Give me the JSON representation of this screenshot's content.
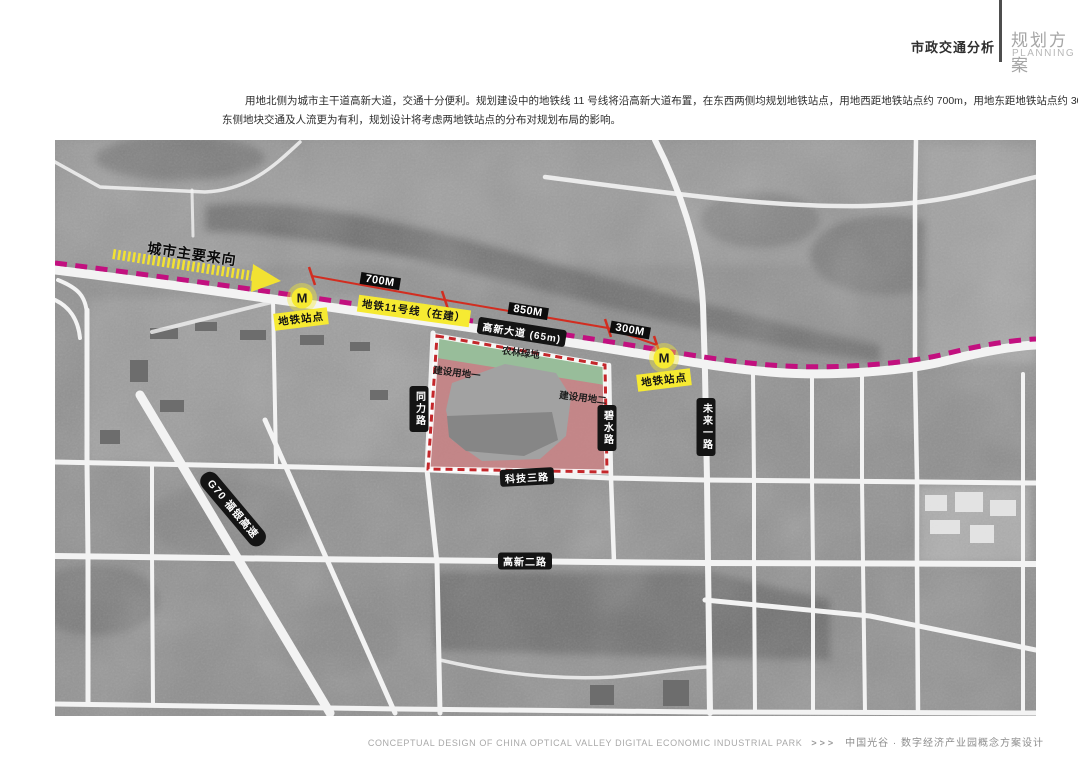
{
  "header": {
    "section_title": "市政交通分析",
    "scheme_title": "规划方案",
    "scheme_subtitle": "PLANNING"
  },
  "intro": {
    "line1": "用地北侧为城市主干道高新大道，交通十分便利。规划建设中的地铁线 11 号线将沿高新大道布置，在东西两侧均规划地铁站点，用地西距地铁站点约 700m，用地东距地铁站点约 300 米；因此，",
    "line2": "东侧地块交通及人流更为有利，规划设计将考虑两地铁站点的分布对规划布局的影响。"
  },
  "map": {
    "city_direction_label": "城市主要来向",
    "metro_line_label": "地铁11号线（在建）",
    "avenue_label": "高新大道 (65m)",
    "measurements": [
      {
        "label": "700M"
      },
      {
        "label": "850M"
      },
      {
        "label": "300M"
      }
    ],
    "stations": [
      {
        "marker": "M",
        "label": "地铁站点"
      },
      {
        "marker": "M",
        "label": "地铁站点"
      }
    ],
    "site": {
      "green_area_label": "农林绿地",
      "parcel_1_label": "建设用地一",
      "parcel_2_label": "建设用地二"
    },
    "roads": {
      "tongli": "同力路",
      "bishui": "碧水路",
      "weilai": "未来一路",
      "keji3": "科技三路",
      "gaoxin2": "高新二路",
      "g70": "G70 福银高速"
    },
    "colors": {
      "metro_magenta": "#c2107f",
      "highlight_yellow": "#f6ea32",
      "measure_red": "#d22d20",
      "boundary_red": "#c4272b",
      "parcel_pink": "#ce8284",
      "green_area": "#96c09b"
    }
  },
  "footer": {
    "title_en": "CONCEPTUAL DESIGN OF CHINA OPTICAL VALLEY DIGITAL ECONOMIC INDUSTRIAL PARK",
    "separator": ">>>",
    "title_zh": "中国光谷 · 数字经济产业园概念方案设计"
  }
}
